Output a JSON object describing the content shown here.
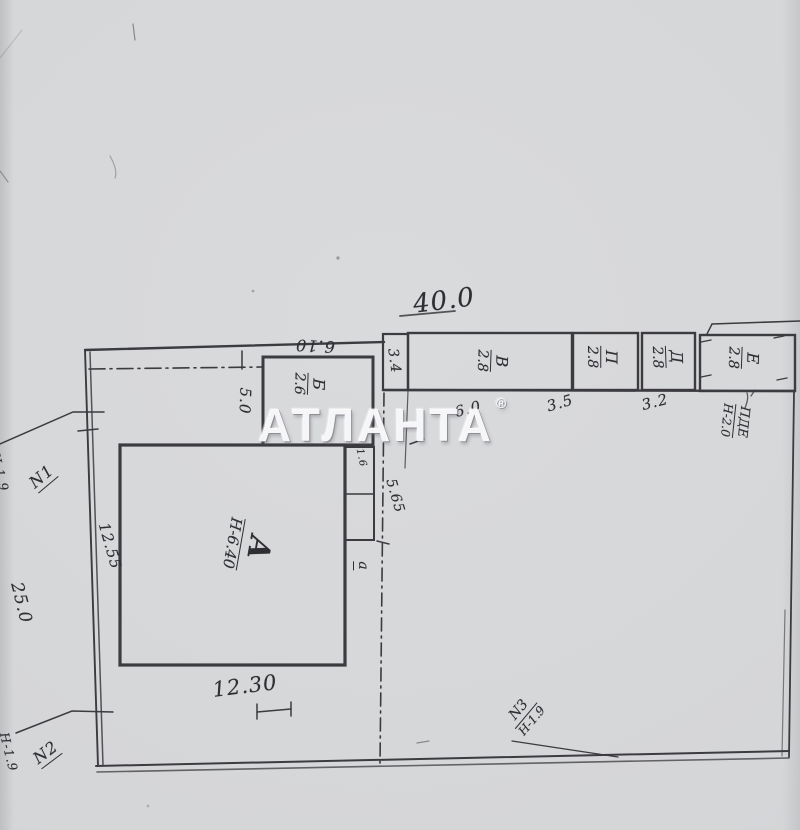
{
  "watermark": {
    "text": "АТЛАНТА",
    "reg": "®"
  },
  "dimensions": {
    "lot_width_top": "40.0",
    "lot_left_outer": "25.0",
    "left_inner": "12.55",
    "building_a_width": "12.30",
    "building_b_width": "6.10",
    "building_b_side": "5.0",
    "shed_strip": "3.4",
    "shed_v_width": "6.0",
    "shed_p_width": "3.5",
    "shed_d_width": "3.2",
    "porch_width": "1.6",
    "yard_gap": "5.65"
  },
  "buildings": {
    "a": {
      "letter": "А",
      "height": "Н-6.40"
    },
    "b": {
      "letter": "Б",
      "height": "2.6"
    },
    "porch": {
      "letter": "а"
    }
  },
  "sheds": [
    {
      "letter": "В",
      "height": "2.8"
    },
    {
      "letter": "П",
      "height": "2.8"
    },
    {
      "letter": "Д",
      "height": "2.8"
    },
    {
      "letter": "Е",
      "height": "2.8"
    }
  ],
  "notes": {
    "shed_note": {
      "top": "ПДЕ",
      "bottom": "Н-2.0"
    }
  },
  "markers": {
    "n1": {
      "label": "N1",
      "height": "Н-1.9"
    },
    "n2": {
      "label": "N2",
      "height": "Н-1.9"
    },
    "n3": {
      "label": "N3",
      "height": "Н-1.9"
    }
  }
}
